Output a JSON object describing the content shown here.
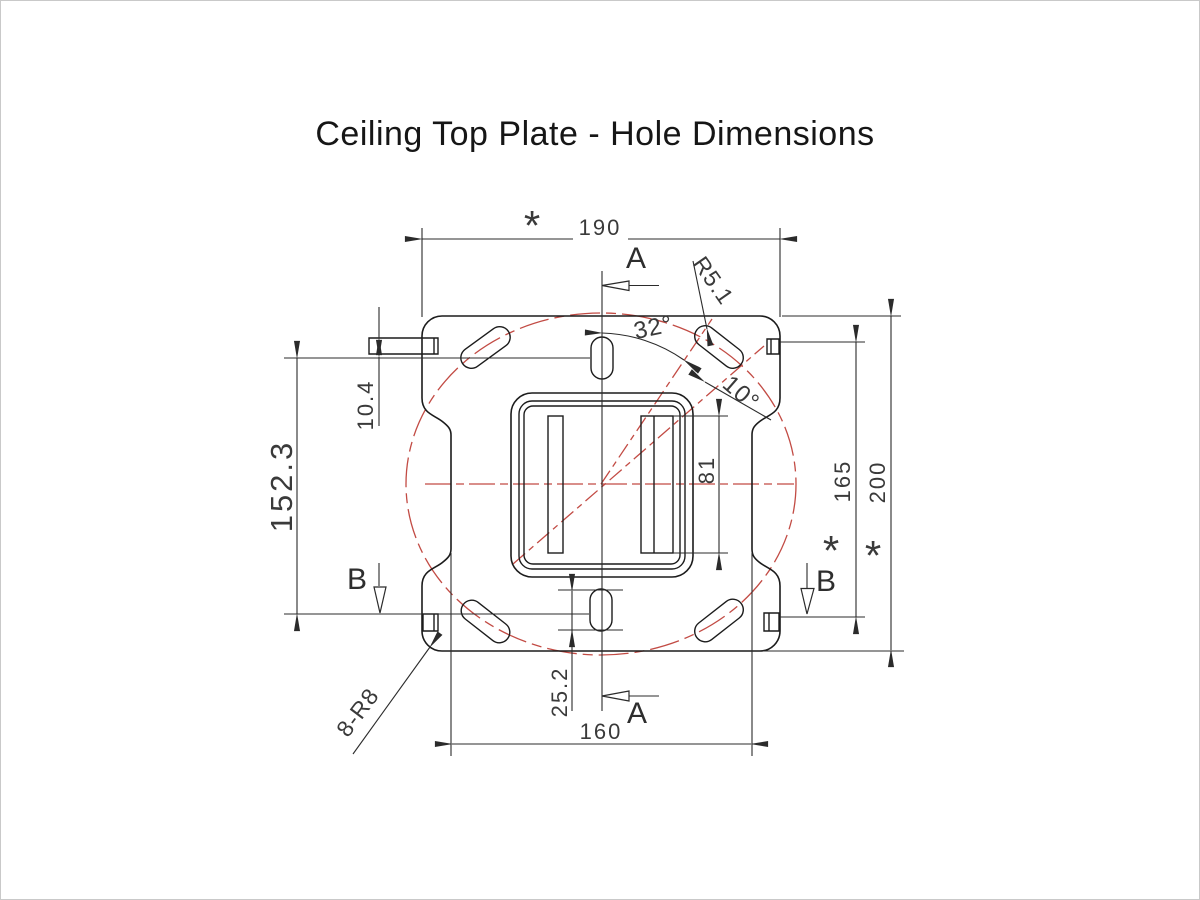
{
  "title": "Ceiling Top Plate - Hole Dimensions",
  "dimensions": {
    "top_width": "190",
    "bottom_width": "160",
    "left_height": "152.3",
    "tab_height": "10.4",
    "right_inner_height": "165",
    "right_outer_height": "200",
    "center_slot_height": "81",
    "bottom_slot_length": "25.2",
    "angle_main": "32°",
    "angle_slot": "10°",
    "slot_corner_radius": "R5.1",
    "plate_corner_radius": "8-R8",
    "asterisk": "*"
  },
  "sections": {
    "a": "A",
    "b": "B"
  },
  "colors": {
    "line": "#1c1c1c",
    "dimension": "#2b2b2b",
    "centerline_red": "#c24b44",
    "background": "#ffffff"
  }
}
